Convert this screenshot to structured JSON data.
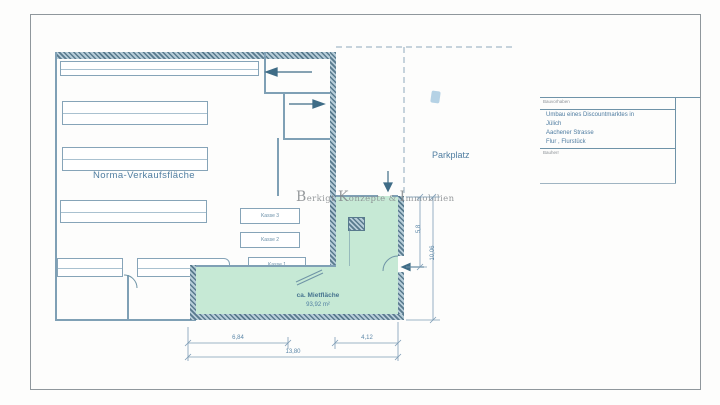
{
  "plan": {
    "sales_area_label": "Norma-Verkaufsfläche",
    "parking_label": "Parkplatz",
    "rental_area": {
      "label": "ca. Mietfläche",
      "value": "93,92 m²"
    },
    "checkouts": {
      "kasse3": "Kasse 3",
      "kasse2": "Kasse 2",
      "kasse1": "Kasse 1"
    },
    "dimensions": {
      "bottom_left": "6,84",
      "bottom_right": "4,12",
      "bottom_total": "13,80",
      "right_inner": "5,8",
      "right_outer": "10,06"
    }
  },
  "watermark": {
    "word1": "Berkigt",
    "word2": "Konzepte",
    "amp": "&",
    "word3": "Immobilien"
  },
  "title_block": {
    "section_label_top": "Bauvorhaben",
    "project_line1": "Umbau eines Discountmarktes in",
    "project_line2": "Jülich",
    "project_line3": "Aachener Strasse",
    "project_line4": "Flur , Flurstück",
    "section_label_bottom": "Bauherr"
  },
  "colors": {
    "line": "#7fa0b5",
    "wall": "#587a8d",
    "rental_fill": "#c6e9d5",
    "text": "#4d7ba0",
    "watermark": "#84888c"
  }
}
